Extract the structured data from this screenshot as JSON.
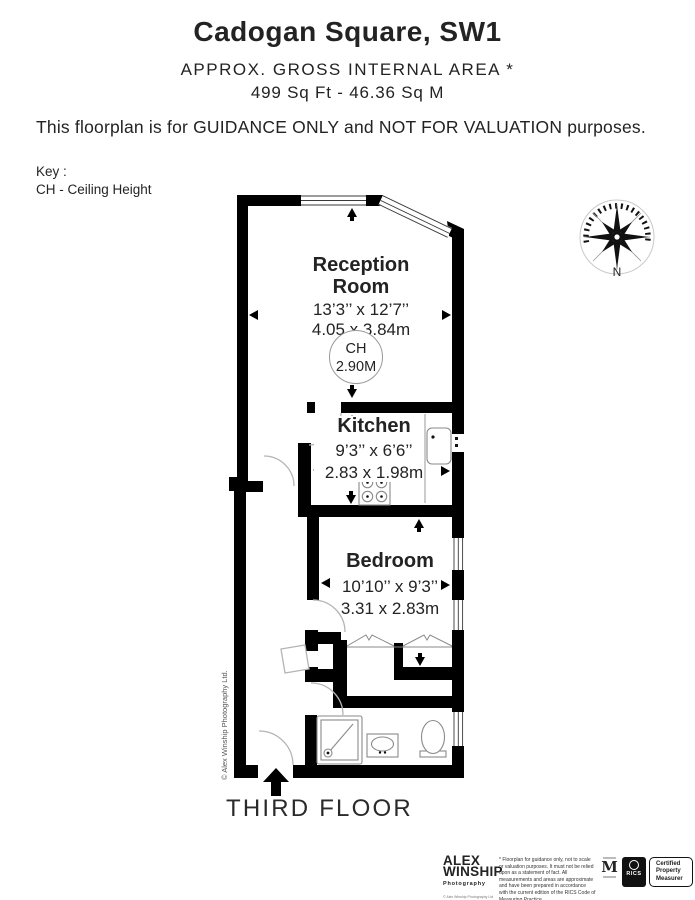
{
  "header": {
    "title": "Cadogan Square, SW1",
    "subtitle_line1": "APPROX. GROSS INTERNAL  AREA *",
    "subtitle_line2": "499 Sq Ft  -  46.36 Sq M",
    "guidance": "This floorplan is for GUIDANCE ONLY and NOT FOR VALUATION purposes.",
    "key_label": "Key :",
    "key_item": "CH - Ceiling Height"
  },
  "plan": {
    "reception": {
      "name_line1": "Reception",
      "name_line2": "Room",
      "dims_imperial": "13’3’’ x 12’7’’",
      "dims_metric": "4.05 x 3.84m",
      "ch_label": "CH",
      "ch_value": "2.90M"
    },
    "kitchen": {
      "name": "Kitchen",
      "dims_imperial": "9’3’’ x 6’6’’",
      "dims_metric": "2.83 x 1.98m"
    },
    "bedroom": {
      "name": "Bedroom",
      "dims_imperial": "10’10’’ x 9’3’’",
      "dims_metric": "3.31 x 2.83m"
    },
    "compass_north": "N",
    "watermark": "© Alex Winship Photography Ltd.",
    "floor_label": "THIRD FLOOR"
  },
  "footer": {
    "logo_line1": "ALEX",
    "logo_line2": "WINSHIP",
    "logo_sub": "Photography",
    "logo_copy": "© Alex Winship Photography Ltd",
    "disclaimer": "* Floorplan for guidance only, not to scale or valuation purposes. It must not be relied upon as a statement of fact. All measurements and areas are approximate and have been prepared in accordance with the current edition of the RICS Code of Measuring Practice.",
    "m_badge": "M",
    "rics_label": "RICS",
    "cert_line1": "Certified",
    "cert_line2": "Property",
    "cert_line3": "Measurer"
  },
  "colors": {
    "wall": "#000000",
    "text": "#232323",
    "thin_line": "#8a8a8a",
    "arc": "#b5b5b5"
  }
}
